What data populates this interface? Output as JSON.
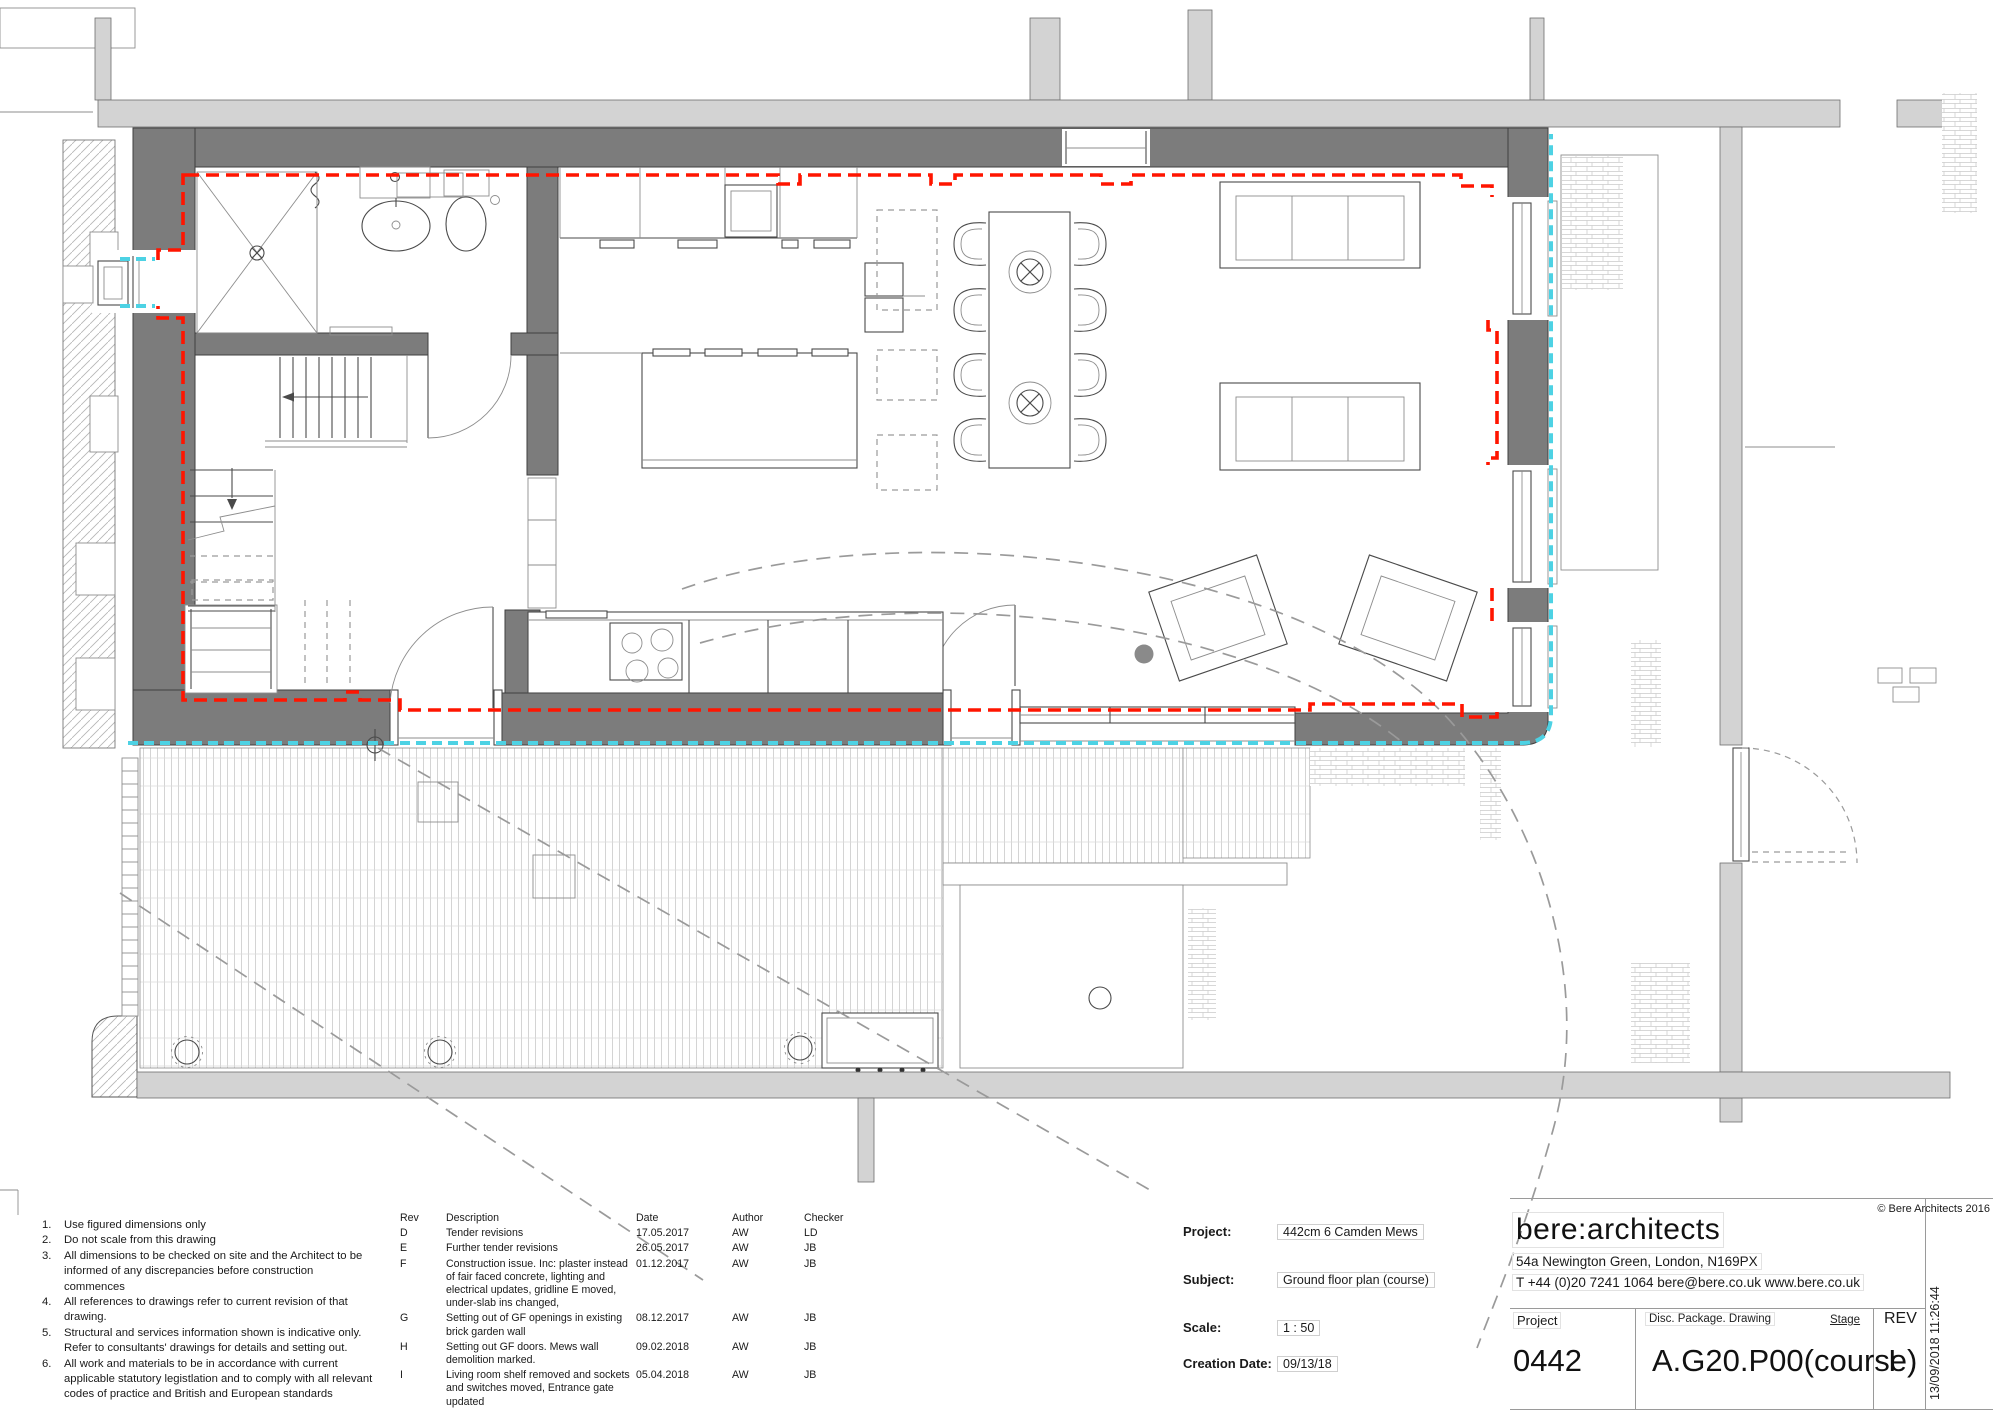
{
  "colors": {
    "wall_dark": "#7c7c7c",
    "wall_light": "#d3d3d3",
    "insulation_red": "#ff1500",
    "airtight_cyan": "#4dd2e4"
  },
  "notes": {
    "items": [
      {
        "num": "1.",
        "text": "Use figured dimensions only"
      },
      {
        "num": "2.",
        "text": "Do not scale from this drawing"
      },
      {
        "num": "3.",
        "text": "All dimensions to be checked on site and the Architect to be informed of any discrepancies before construction commences"
      },
      {
        "num": "4.",
        "text": "All references to drawings refer to current revision of that drawing."
      },
      {
        "num": "5.",
        "text": "Structural and services information shown is indicative only. Refer to consultants' drawings for details and setting out."
      },
      {
        "num": "6.",
        "text": "All work and materials to be in accordance with current applicable statutory legistlation and to comply with all relevant codes of practice and British and European standards"
      }
    ]
  },
  "revision_table": {
    "headers": [
      "Rev",
      "Description",
      "Date",
      "Author",
      "Checker"
    ],
    "rows": [
      {
        "rev": "D",
        "description": "Tender revisions",
        "date": "17.05.2017",
        "author": "AW",
        "checker": "LD"
      },
      {
        "rev": "E",
        "description": "Further tender revisions",
        "date": "26.05.2017",
        "author": "AW",
        "checker": "JB"
      },
      {
        "rev": "F",
        "description": "Construction issue.  Inc: plaster instead of fair faced concrete, lighting and electrical updates, gridline E moved, under-slab ins changed,",
        "date": "01.12.2017",
        "author": "AW",
        "checker": "JB"
      },
      {
        "rev": "G",
        "description": "Setting out of GF openings in existing brick garden wall",
        "date": "08.12.2017",
        "author": "AW",
        "checker": "JB"
      },
      {
        "rev": "H",
        "description": "Setting out GF doors.  Mews wall demolition marked.",
        "date": "09.02.2018",
        "author": "AW",
        "checker": "JB"
      },
      {
        "rev": "I",
        "description": "Living room shelf removed and sockets and switches moved, Entrance gate updated",
        "date": "05.04.2018",
        "author": "AW",
        "checker": "JB"
      }
    ]
  },
  "project_info": {
    "project_label": "Project:",
    "project_value": "442cm 6 Camden Mews",
    "subject_label": "Subject:",
    "subject_value": "Ground floor plan (course)",
    "scale_label": "Scale:",
    "scale_value": "1 : 50",
    "creation_label": "Creation Date:",
    "creation_value": "09/13/18"
  },
  "firm": {
    "name": "bere:architects",
    "address": "54a Newington Green, London, N169PX",
    "contact": "T +44 (0)20 7241 1064   bere@bere.co.uk   www.bere.co.uk",
    "copyright": "© Bere Architects 2016"
  },
  "title_block": {
    "project_label": "Project",
    "project_number": "0442",
    "drawing_label": "Disc. Package. Drawing",
    "drawing_number": "A.G20.P00(course)",
    "stage_label": "Stage",
    "rev_label": "REV",
    "rev_value": "I"
  },
  "timestamp": "13/09/2018 11:26:44"
}
